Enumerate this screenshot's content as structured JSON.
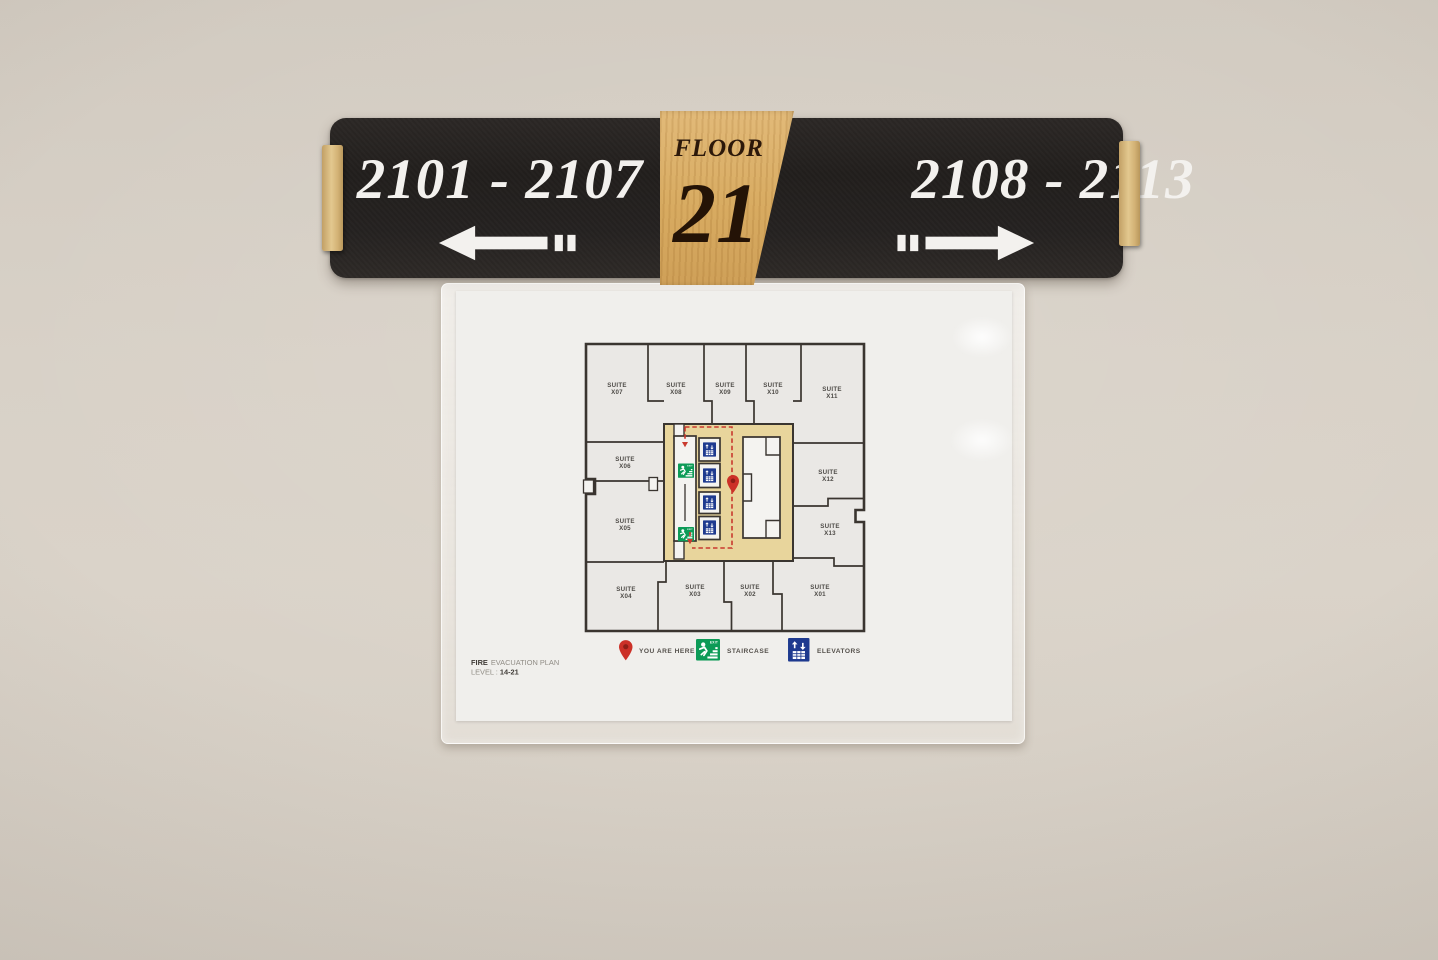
{
  "photo": {
    "wall_color": "#d6cfc5"
  },
  "sign": {
    "left_range": "2101 - 2107",
    "right_range": "2108 - 2113",
    "floor_word": "FLOOR",
    "floor_number": "21",
    "colors": {
      "plate": "#262320",
      "wood": "#d9ad62",
      "text": "#f3f1ee"
    }
  },
  "plan": {
    "title_bold": "FIRE",
    "title_rest": "EVACUATION PLAN",
    "level_label": "LEVEL :",
    "level_value": "14-21",
    "suite_word": "SUITE",
    "suites": {
      "top": [
        "X07",
        "X08",
        "X09",
        "X10",
        "X11"
      ],
      "left": [
        "X06",
        "X05"
      ],
      "right": [
        "X12",
        "X13"
      ],
      "bottom": [
        "X04",
        "X03",
        "X02",
        "X01"
      ]
    },
    "legend": [
      {
        "name": "you-are-here-pin",
        "label": "YOU ARE HERE"
      },
      {
        "name": "staircase",
        "label": "STAIRCASE"
      },
      {
        "name": "elevators",
        "label": "ELEVATORS"
      }
    ],
    "colors": {
      "corridor": "#e8d59c",
      "suite": "#eae8e5",
      "walls": "#3a3530",
      "exit_green": "#0d9b57",
      "elevator_blue": "#1e3a8f",
      "route_red": "#c93a2e"
    }
  }
}
